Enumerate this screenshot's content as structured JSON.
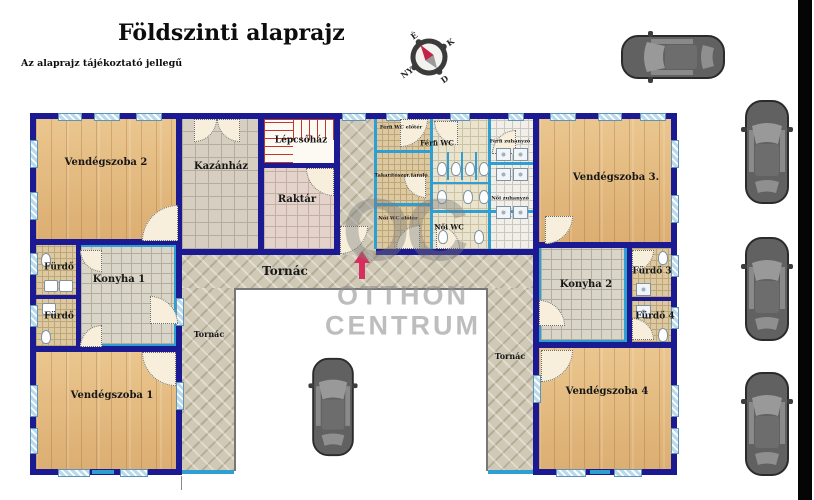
{
  "header": {
    "title": "Földszinti alaprajz",
    "subtitle": "Az alaprajz tájékoztató jellegű"
  },
  "compass": {
    "north": "É",
    "east": "K",
    "south": "D",
    "west": "NY"
  },
  "watermark": {
    "initials": "OC",
    "line1": "OTTHON",
    "line2": "CENTRUM"
  },
  "rooms": {
    "vendegszoba1": "Vendégszoba 1",
    "vendegszoba2": "Vendégszoba 2",
    "vendegszoba3": "Vendégszoba 3.",
    "vendegszoba4": "Vendégszoba 4",
    "kazanhaz": "Kazánház",
    "lepcsohaz": "Lépcsőház",
    "raktar": "Raktár",
    "tornac_main": "Tornác",
    "tornac_left": "Tornác",
    "tornac_right": "Tornác",
    "furdo_1": "Fürdő",
    "furdo_2": "Fürdő",
    "furdo_3": "Fürdő 3",
    "furdo_4": "Fürdő 4",
    "konyha_1": "Konyha 1",
    "konyha_2": "Konyha 2",
    "ferfi_wc_eloter": "Férfi WC előtér",
    "ferfi_wc": "Férfi WC",
    "ferfi_zuhanyzo": "Férfi zuhanyzó",
    "takaritoszer_tarolo": "Takarítószer tároló",
    "noi_zuhanyzo": "Női zuhanyzó",
    "noi_wc_eloter": "Női WC előtér",
    "noi_wc": "Női WC"
  },
  "colors": {
    "wall": "#1c1a92",
    "partition": "#2f9fd2",
    "window": "#b9d9ec",
    "wood_floor": "#e6bf85",
    "arrow": "#d62e5e",
    "stairs_outline": "#c0392b",
    "watermark_gray": "#9e9e9e",
    "car_body": "#616161",
    "photo_bar": "#050505"
  }
}
